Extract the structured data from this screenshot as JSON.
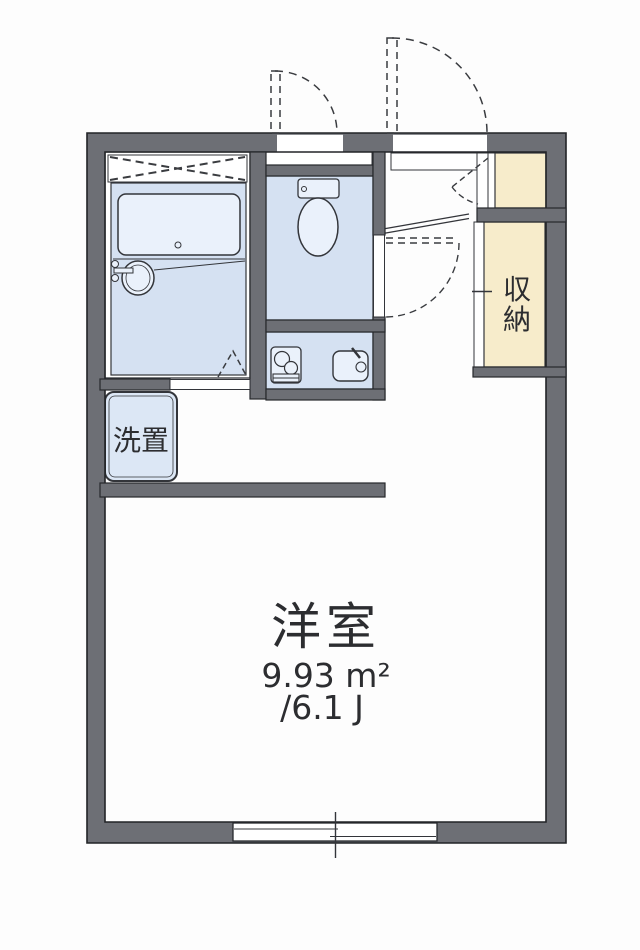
{
  "plan": {
    "main_room": {
      "name": "洋室",
      "area_sqm": "9.93 m²",
      "area_tatami": "/6.1 J"
    },
    "closet": {
      "label": "収納",
      "chars": [
        "収",
        "納"
      ]
    },
    "laundry": {
      "label": "洗置"
    },
    "fixtures": [
      "bathtub",
      "washbasin",
      "toilet",
      "gas-stove",
      "kitchen-sink",
      "sliding-window",
      "entrance-door",
      "ps-door",
      "toilet-door",
      "bathroom-folding-door",
      "storage-door",
      "shoe-cabinet"
    ],
    "colors": {
      "wall": "#6d6f75",
      "wet_floor": "#d5e1f2",
      "fixture_fill": "#eaf1fb",
      "closet_fill": "#f7eccb",
      "outline": "#33353a",
      "text": "#2c2d30"
    }
  }
}
